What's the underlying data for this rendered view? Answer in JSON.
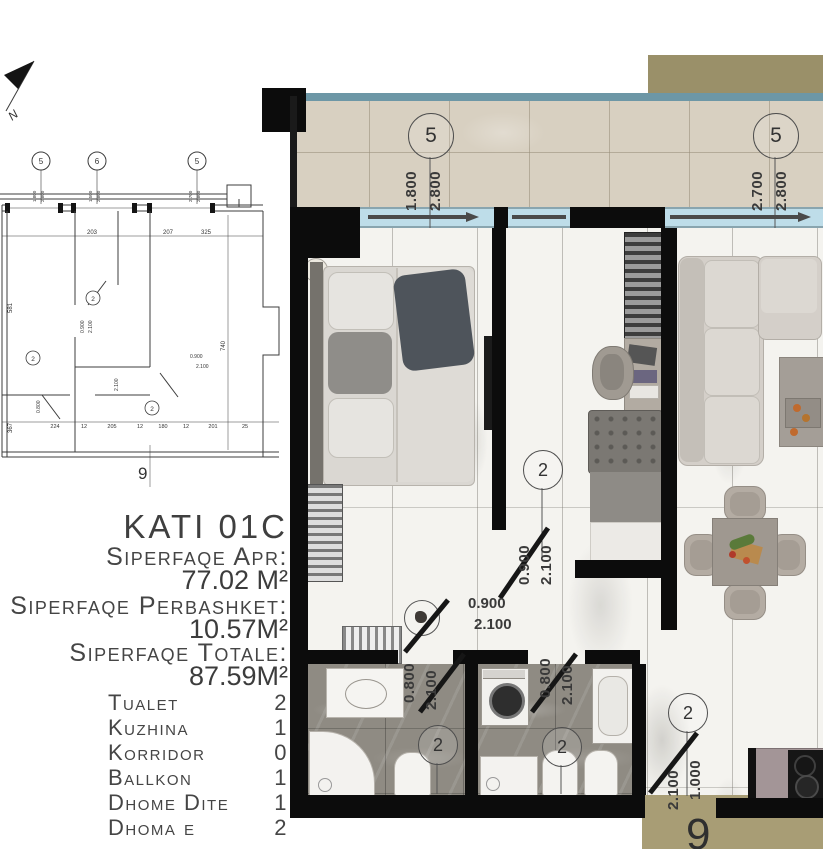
{
  "info_panel": {
    "title": "KATI 01C",
    "area_lines": [
      {
        "label": "Siperfaqe Apr:",
        "value": "77.02 M²"
      },
      {
        "label": "Siperfaqe Perbashket:",
        "value": "10.57M²"
      },
      {
        "label": "Siperfaqe Totale:",
        "value": "87.59M²"
      }
    ],
    "rooms": [
      {
        "name": "Tualet",
        "count": "2"
      },
      {
        "name": "Kuzhina",
        "count": "1"
      },
      {
        "name": "Korridor",
        "count": "0"
      },
      {
        "name": "Ballkon",
        "count": "1"
      },
      {
        "name": "Dhome Dite",
        "count": "1"
      },
      {
        "name": "Dhoma e fjetjes",
        "count": "2"
      }
    ]
  },
  "plan": {
    "north": "N",
    "bubbles": {
      "balcony_left": "5",
      "balcony_right": "5",
      "bedroom2_door": "2",
      "bathroom1": "2",
      "bathroom2": "2",
      "hall": "2"
    },
    "dims": {
      "window_left": [
        "1.800",
        "2.800"
      ],
      "window_right": [
        "2.700",
        "2.800"
      ],
      "bedroom2_door": [
        "0.900",
        "2.100"
      ],
      "corridor_door": [
        "0.900",
        "2.100"
      ],
      "bathroom1_door": [
        "0.800",
        "2.100"
      ],
      "bathroom2_door": [
        "0.800",
        "2.100"
      ],
      "balcony_door": [
        "1.000",
        "2.100"
      ],
      "grid_bottom": "9"
    },
    "colors": {
      "wall": "#0c0c0c",
      "window_glass": "#bedde9",
      "balcony_tile": "#d8d0c1",
      "teal_edge": "#6d97a6",
      "tan_block": "#9a9069",
      "stone_floor": "#8f8b83",
      "marble_floor": "#f4f3ef"
    }
  },
  "tech_drawing": {
    "bubbles": [
      "5",
      "6",
      "5"
    ],
    "window_dims": [
      [
        "1.800",
        "2.800"
      ],
      [
        "1.500",
        "2.800"
      ],
      [
        "2.700",
        "2.800"
      ]
    ],
    "top_dims": [
      "203",
      "207",
      "325"
    ],
    "left_dims": [
      "581",
      "367"
    ],
    "right_dim": "740",
    "bottom_dims": [
      "224",
      "12",
      "205",
      "12",
      "180",
      "12",
      "201",
      "25"
    ],
    "door_dims": [
      "0.900",
      "2.100",
      "0.800",
      "2.100"
    ],
    "mid_dims": [
      "0.900",
      "2.100"
    ],
    "circle_labels": [
      "2",
      "2",
      "2"
    ],
    "grid_bottom": "9"
  }
}
